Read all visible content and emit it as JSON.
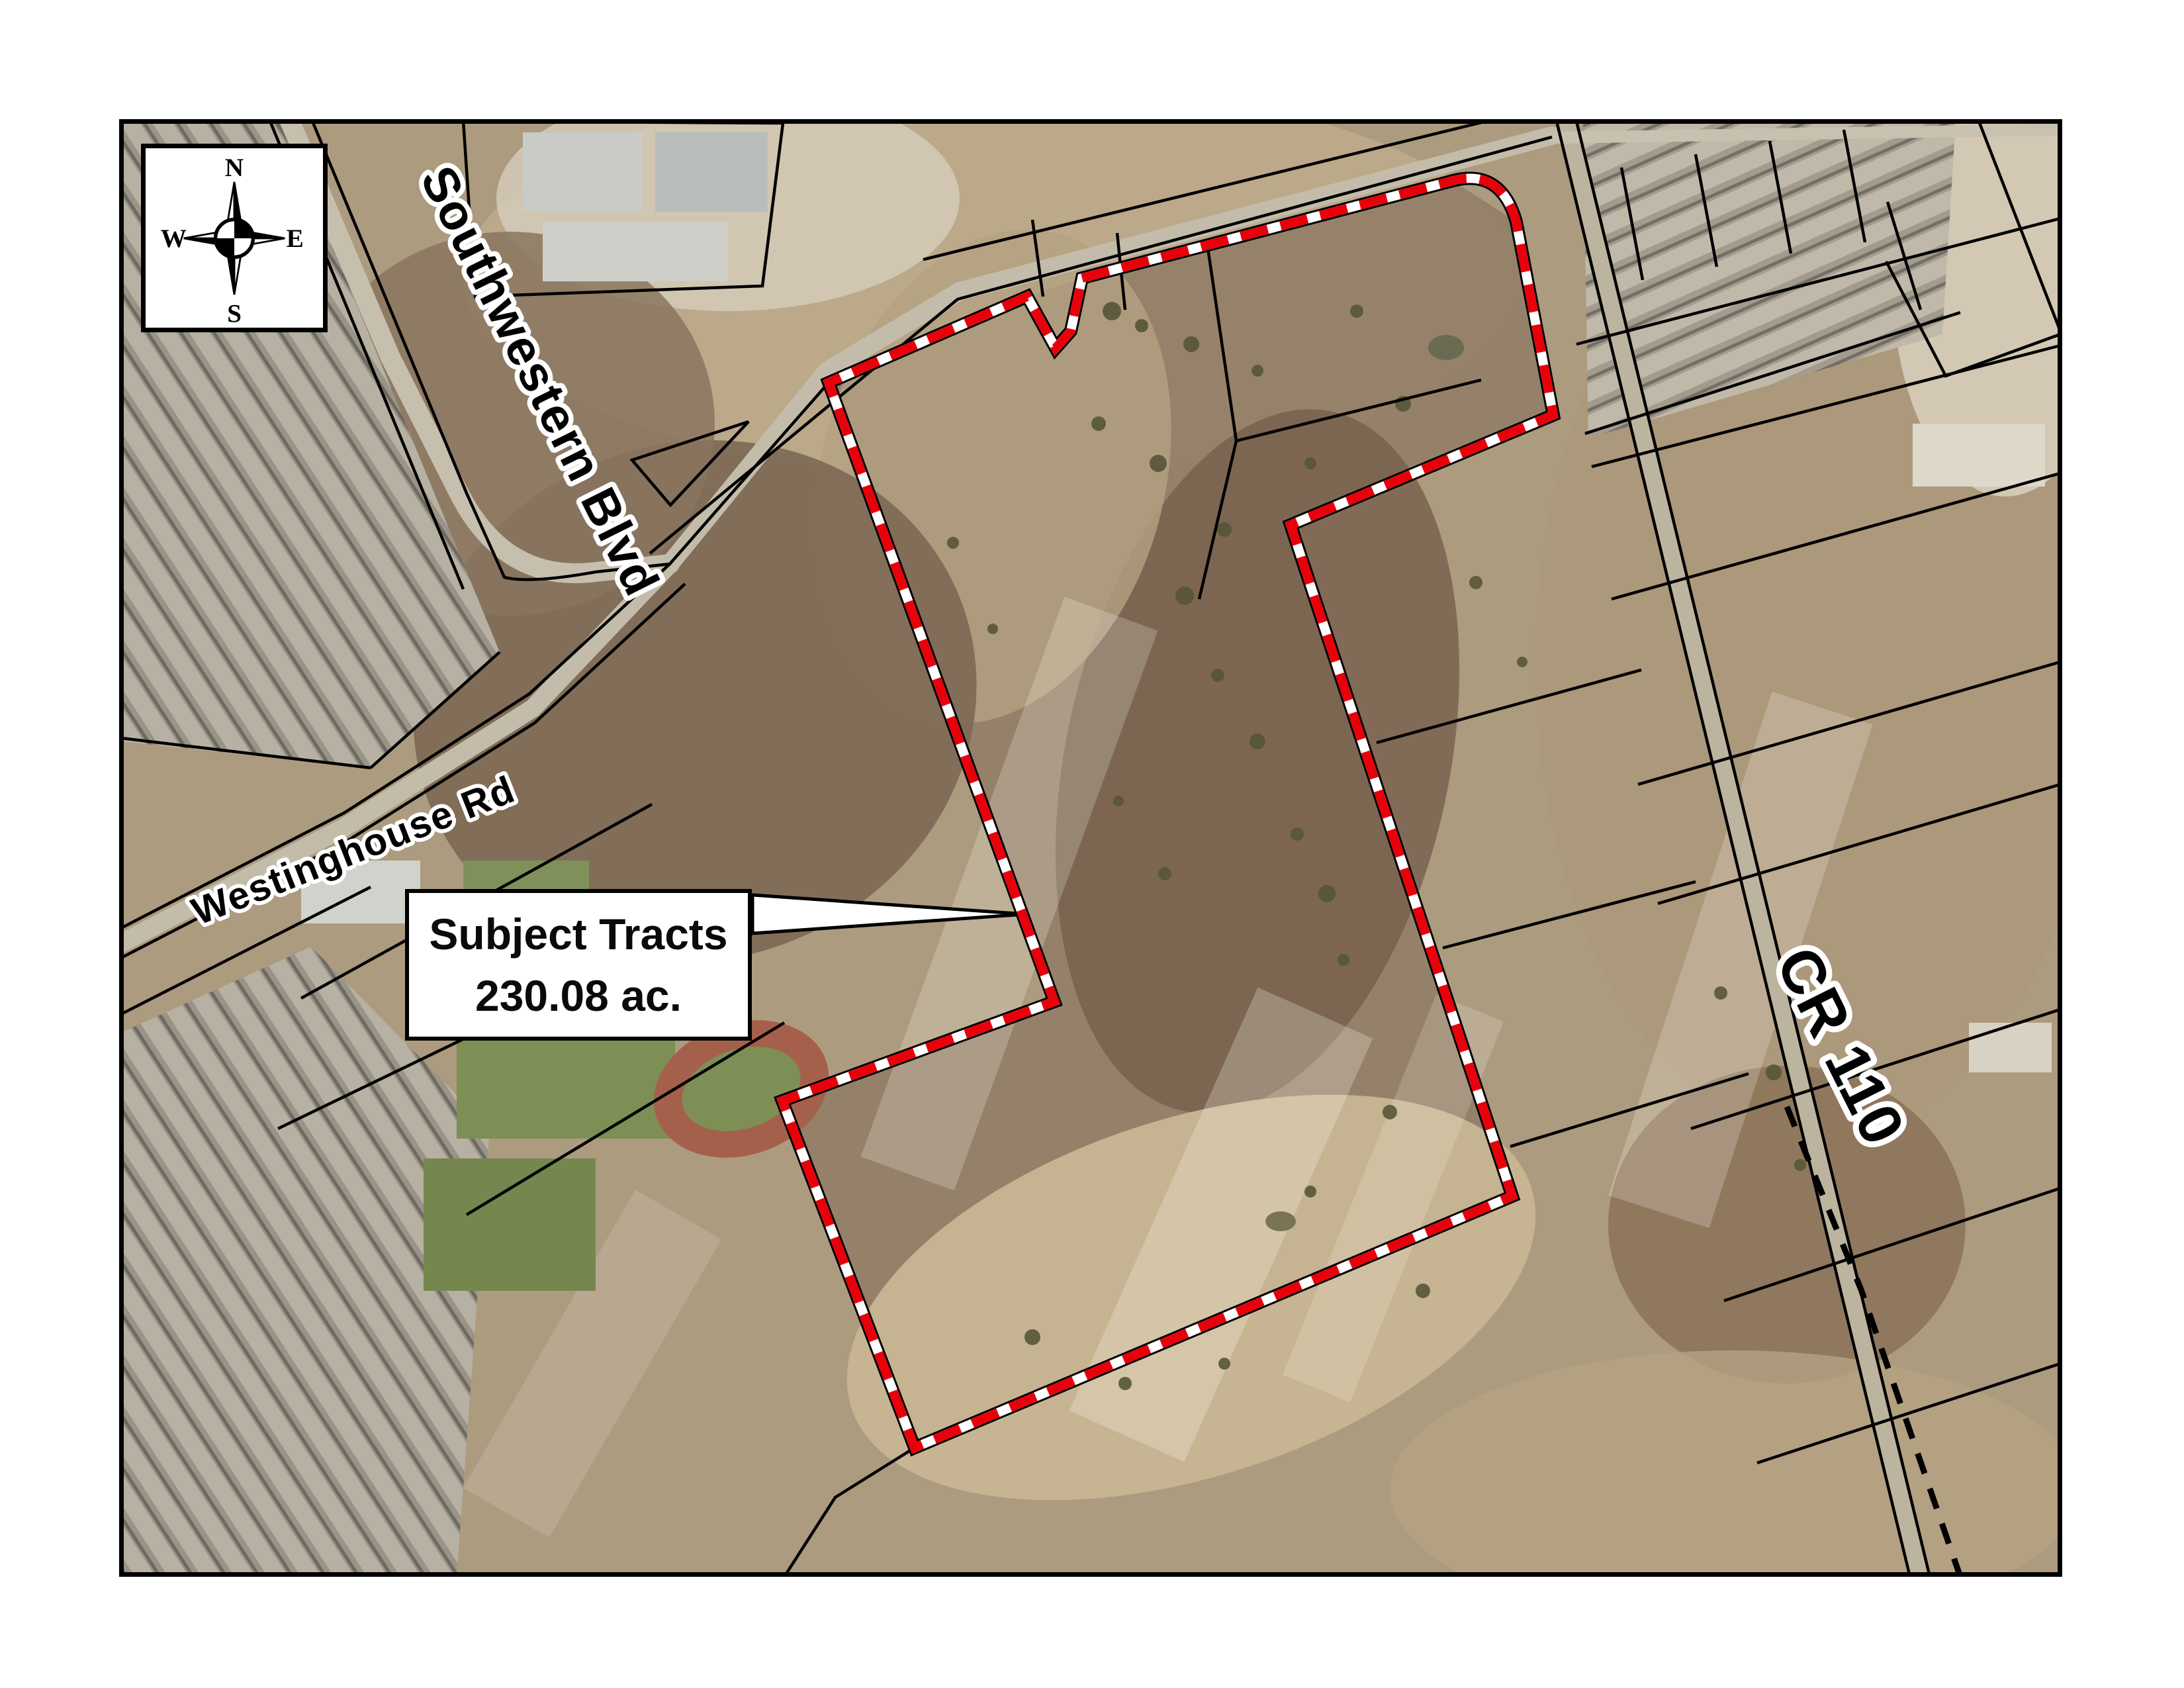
{
  "compass": {
    "north": "N",
    "east": "E",
    "south": "S",
    "west": "W"
  },
  "roads": [
    {
      "label": "Southwestern Blvd"
    },
    {
      "label": "Westinghouse Rd"
    },
    {
      "label": "CR 110"
    }
  ],
  "callout": {
    "line1": "Subject Tracts",
    "line2": "230.08 ac."
  },
  "boundary": {
    "name": "Subject tract boundary",
    "color": "#e8000b",
    "gap_color": "#ffffff",
    "casing": "#000000"
  },
  "colors": {
    "page_bg": "#ffffff",
    "map_border": "#000000",
    "parcel_line": "#000000"
  }
}
